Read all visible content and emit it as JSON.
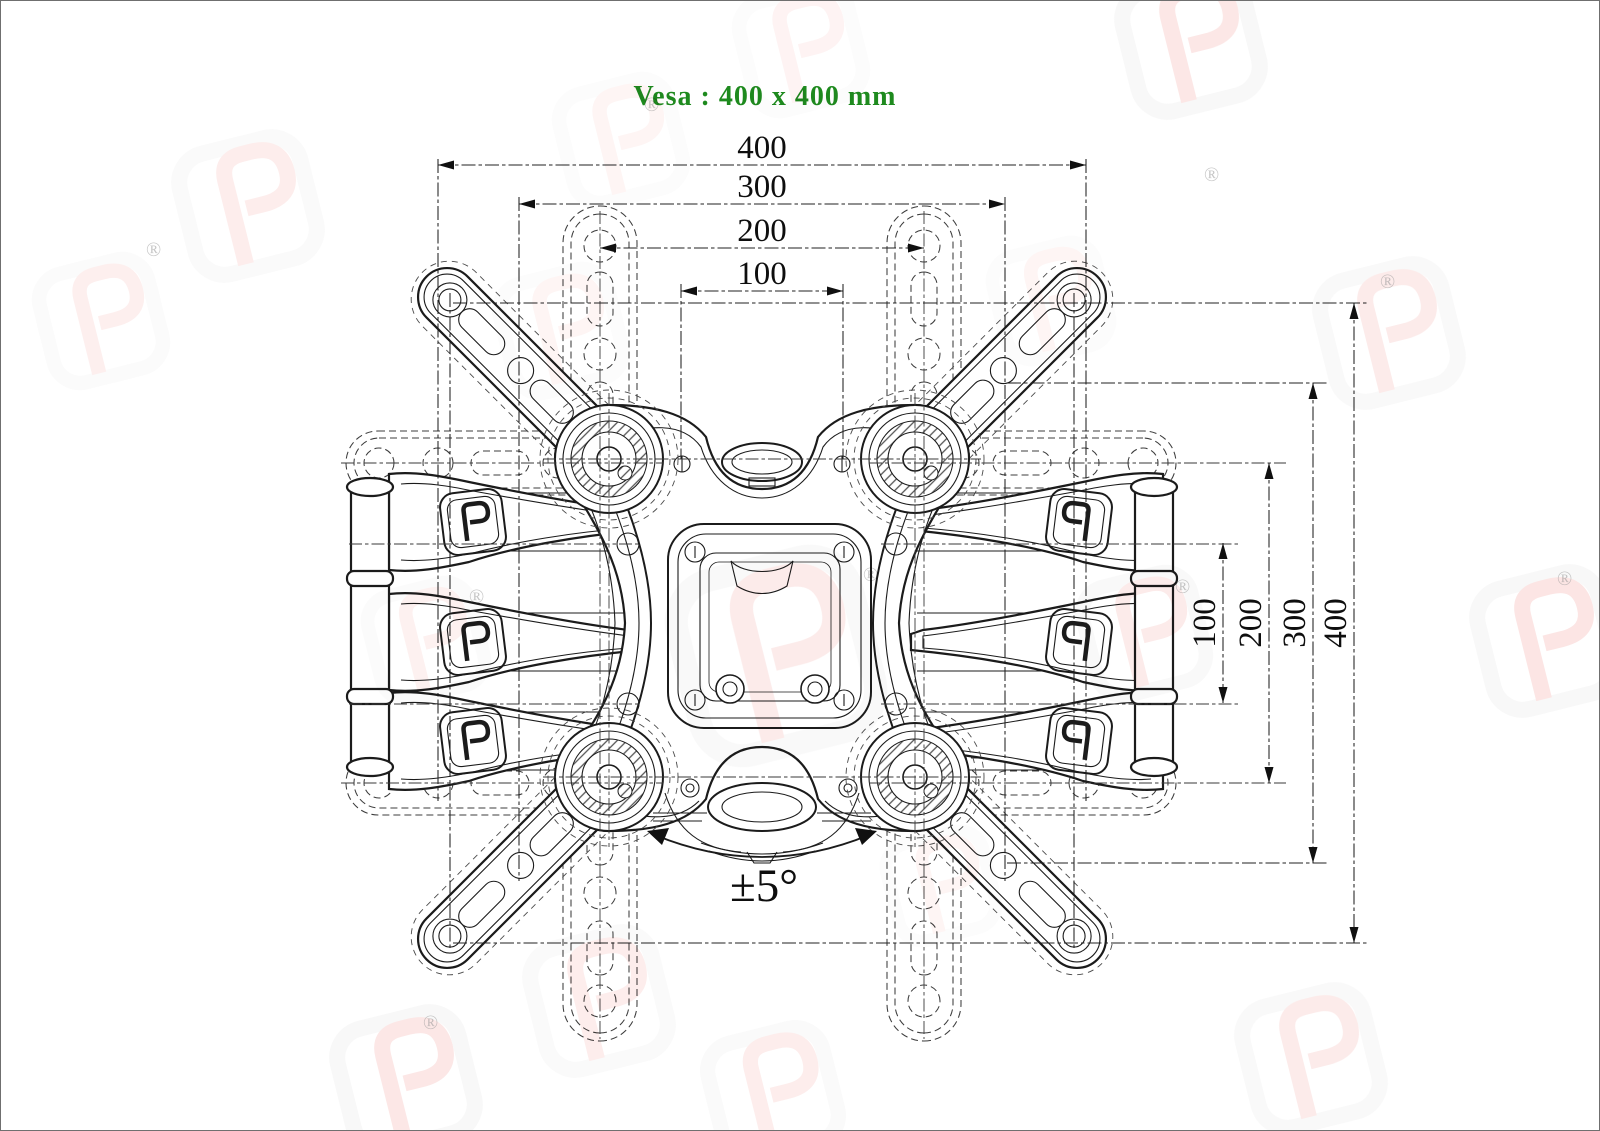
{
  "title": {
    "text": "Vesa : 400 x 400 mm",
    "color": "#1e8a1e"
  },
  "dimensions": {
    "horizontal": {
      "values": [
        "400",
        "300",
        "200",
        "100"
      ]
    },
    "vertical": {
      "values": [
        "100",
        "200",
        "300",
        "400"
      ]
    }
  },
  "annotations": {
    "tilt_range": "±5°"
  },
  "watermark": {
    "registered": "®",
    "brand_color": "#e23b30"
  },
  "drawing": {
    "line_color": "#1b1b1b",
    "background": "#ffffff"
  }
}
